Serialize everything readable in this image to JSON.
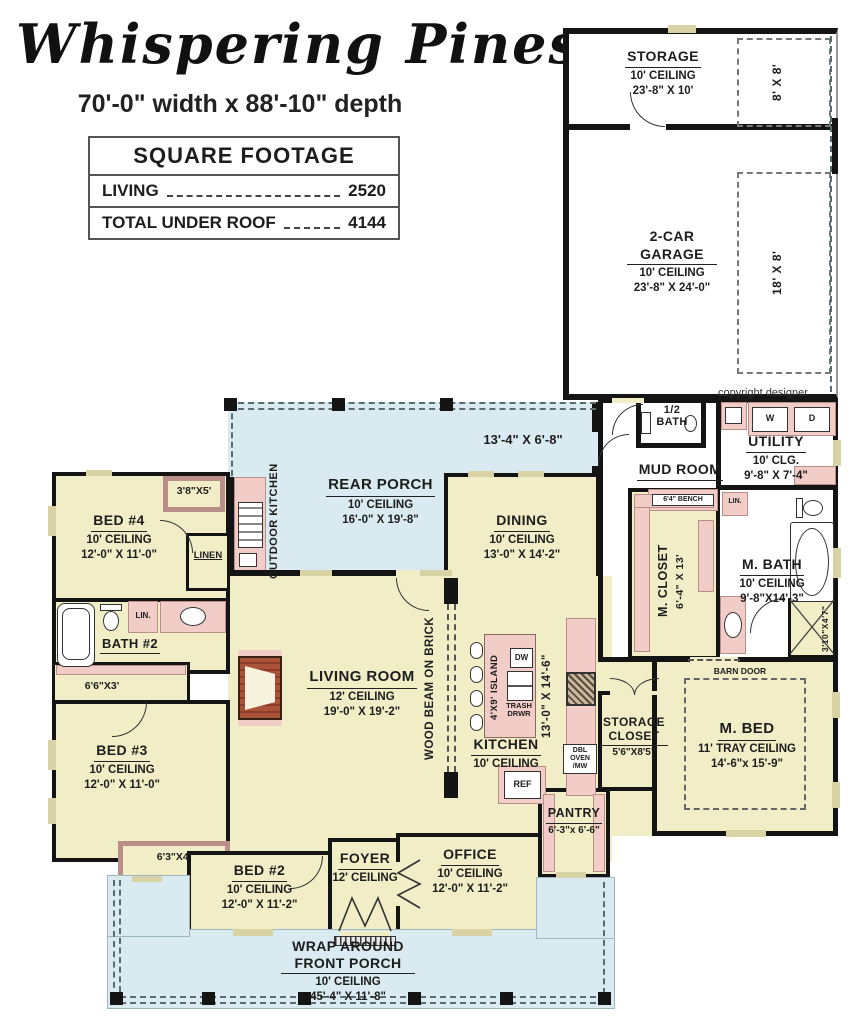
{
  "header": {
    "title": "Whispering Pines",
    "subtitle": "70'-0\" width x 88'-10\" depth",
    "table": {
      "heading": "SQUARE FOOTAGE",
      "rows": [
        {
          "label": "LIVING",
          "value": "2520"
        },
        {
          "label": "TOTAL UNDER ROOF",
          "value": "4144"
        }
      ]
    }
  },
  "plan": {
    "copyright": "copyright designer",
    "rooms": {
      "storage": {
        "name": "STORAGE",
        "line2": "10' CEILING",
        "line3": "23'-8\" X 10'"
      },
      "garage": {
        "name": "2-CAR GARAGE",
        "line2": "10' CEILING",
        "line3": "23'-8\" X 24'-0\""
      },
      "rear_porch": {
        "name": "REAR PORCH",
        "line2": "10' CEILING",
        "line3": "16'-0\" X 19'-8\""
      },
      "dining": {
        "name": "DINING",
        "line2": "10' CEILING",
        "line3": "13'-0\" X 14'-2\""
      },
      "bed4": {
        "name": "BED #4",
        "line2": "10' CEILING",
        "line3": "12'-0\" X 11'-0\""
      },
      "bath2": {
        "name": "BATH #2"
      },
      "bed3": {
        "name": "BED #3",
        "line2": "10' CEILING",
        "line3": "12'-0\" X 11'-0\""
      },
      "living": {
        "name": "LIVING ROOM",
        "line2": "12' CEILING",
        "line3": "19'-0\" X 19'-2\""
      },
      "kitchen": {
        "name": "KITCHEN",
        "line2": "10' CEILING"
      },
      "mud_room": {
        "name": "MUD ROOM"
      },
      "half_bath": {
        "name": "1/2 BATH"
      },
      "utility": {
        "name": "UTILITY",
        "line2": "10' CLG.",
        "line3": "9'-8\" X 7'-4\""
      },
      "m_closet": {
        "name": "M. CLOSET",
        "line2": "6'-4\" X 13'"
      },
      "m_bath": {
        "name": "M. BATH",
        "line2": "10' CEILING",
        "line3": "9'-8\"X14'-3\""
      },
      "m_bed": {
        "name": "M. BED",
        "line2": "11' TRAY CEILING",
        "line3": "14'-6\"x 15'-9\""
      },
      "storage_closet": {
        "name": "STORAGE CLOSET",
        "line2": "5'6\"X8'5\""
      },
      "pantry": {
        "name": "PANTRY",
        "line2": "6'-3\"x 6'-6\""
      },
      "bed2": {
        "name": "BED #2",
        "line2": "10' CEILING",
        "line3": "12'-0\" X 11'-2\""
      },
      "foyer": {
        "name": "FOYER",
        "line2": "12' CEILING"
      },
      "office": {
        "name": "OFFICE",
        "line2": "10' CEILING",
        "line3": "12'-0\" X 11'-2\""
      },
      "front_porch": {
        "name": "WRAP AROUND FRONT PORCH",
        "line2": "10' CEILING",
        "line3": "45'-4\" X 11'-8\""
      }
    },
    "labels": {
      "storage_pad": "8' X 8'",
      "garage_pad": "18' X 8'",
      "porch_dining_dim": "13'-4\" X 6'-8\"",
      "outdoor_kitchen": "OUTDOOR KITCHEN",
      "wood_beam": "WOOD BEAM ON BRICK",
      "island": "4'X9' ISLAND",
      "island_dw": "DW",
      "island_trash": "TRASH DRWR",
      "kitchen_dim": "13'-0\" X 14'-6\"",
      "ref": "REF",
      "dbl_oven": "DBL OVEN /MW",
      "washer": "W",
      "dryer": "D",
      "bench": "6'4\" BENCH",
      "linen": "LINEN",
      "lin_small": "LIN.",
      "lin_small2": "LIN.",
      "barn_door": "BARN DOOR",
      "shower_dim": "3'10\"X4'7\"",
      "bed4_closet": "3'8\"X5'",
      "bed3_closet": "6'6\"X3'",
      "bed2_closet": "6'3\"X4'"
    },
    "colors": {
      "room": "#f1edc6",
      "wet": "#f2ccc6",
      "porch": "#d9eaf0",
      "wall": "#141414",
      "window": "#d9d2a4",
      "brick": "#a85238"
    }
  }
}
